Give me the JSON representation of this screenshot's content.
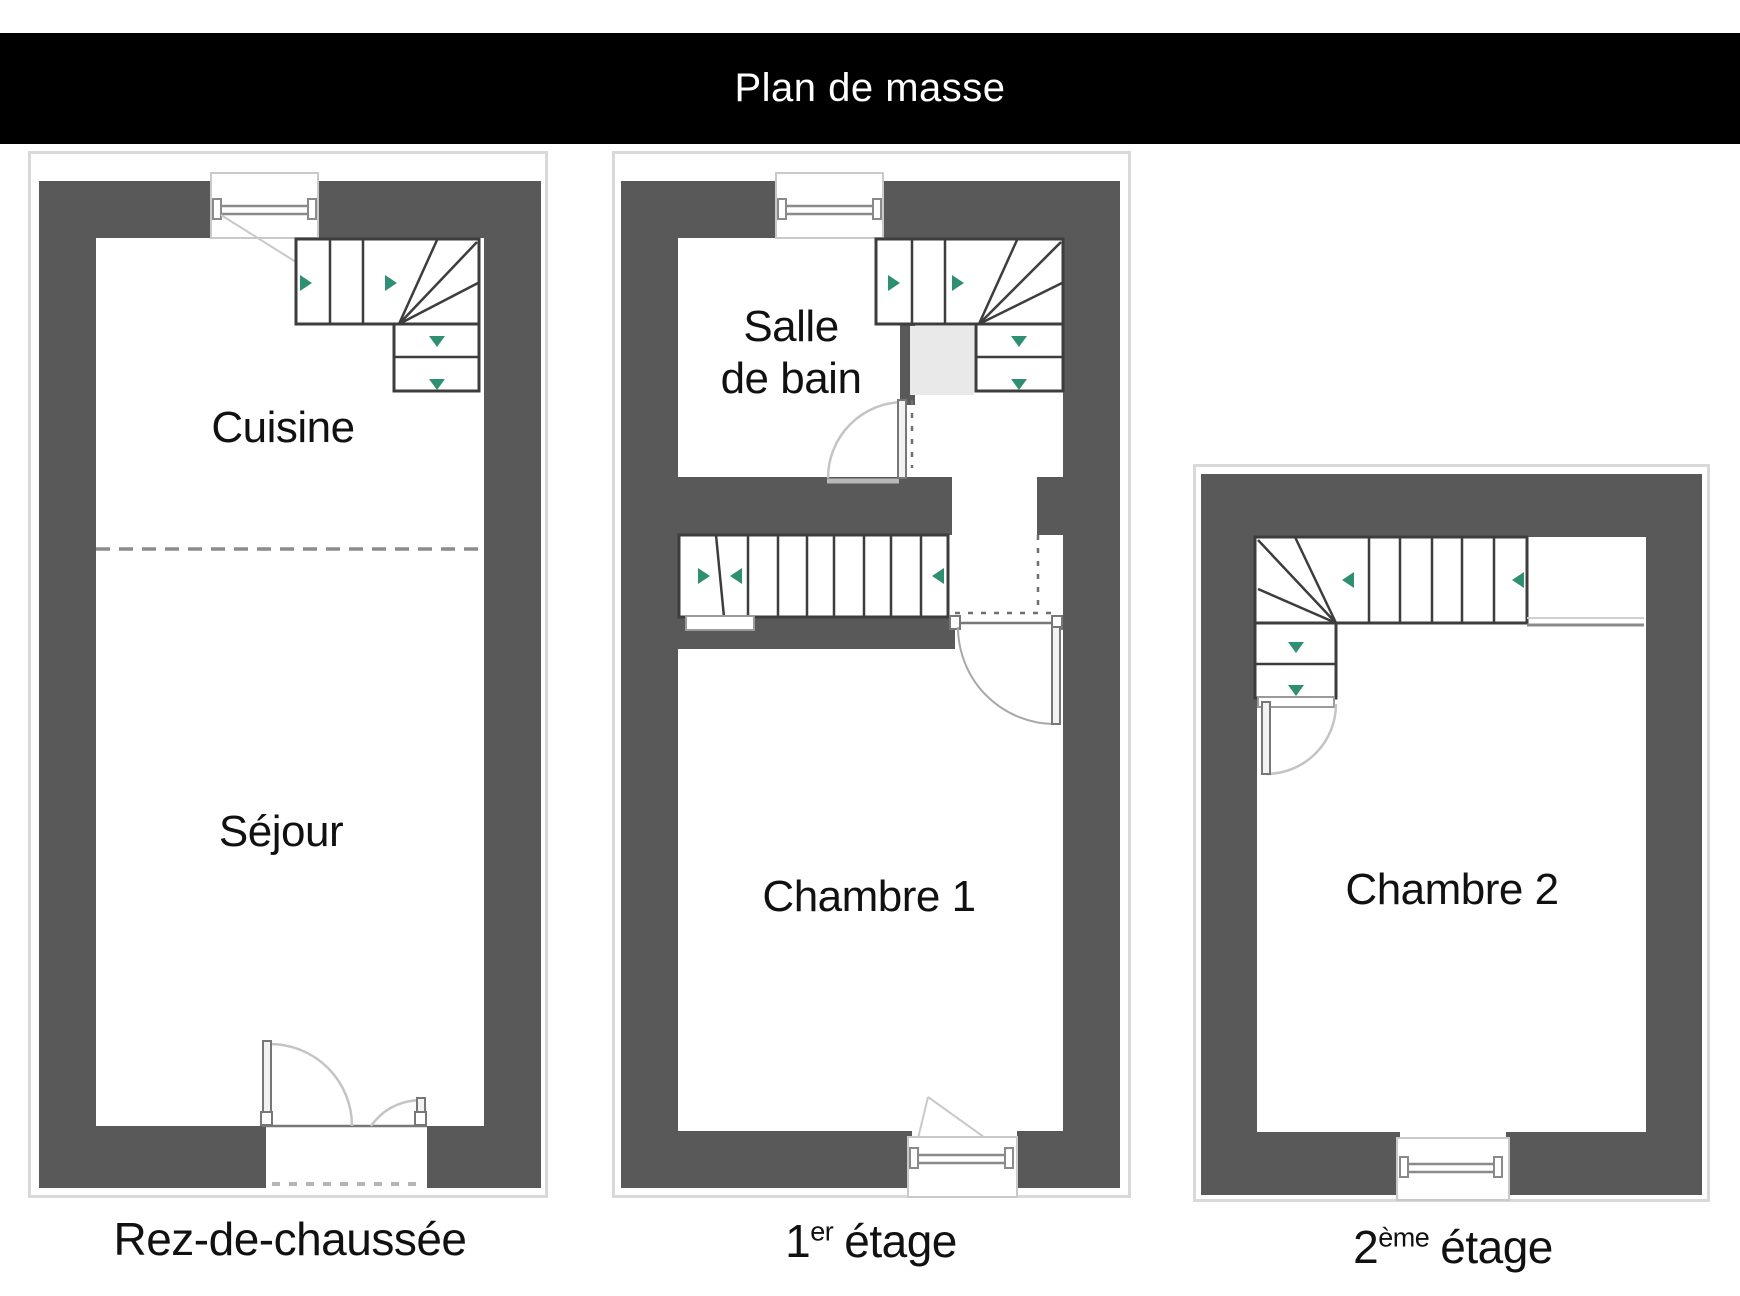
{
  "title": "Plan de masse",
  "colors": {
    "title_bg": "#000000",
    "title_text": "#ffffff",
    "wall": "#595959",
    "frame": "#d9d9d9",
    "stair_outline": "#3d3d3d",
    "arrow_green": "#2f8f72",
    "swing_arc": "#c4c4c4",
    "shade": "#e9e9e9",
    "label_text": "#111111"
  },
  "icons": {
    "stair_direction_arrow": "filled-triangle (green), points along stair travel",
    "window_symbol": "double parallel lines with end caps in wall opening",
    "door_swing": "quarter-circle arc with door leaf"
  },
  "floors": [
    {
      "id": "rdc",
      "caption": {
        "num": "Rez-de-chaussée",
        "sup": "",
        "rest": ""
      },
      "rooms": [
        {
          "label": "Cuisine"
        },
        {
          "label": "Séjour"
        }
      ]
    },
    {
      "id": "etage1",
      "caption": {
        "num": "1",
        "sup": "er",
        "rest": "étage"
      },
      "rooms": [
        {
          "label_line1": "Salle",
          "label_line2": "de bain"
        },
        {
          "label": "Chambre 1"
        }
      ]
    },
    {
      "id": "etage2",
      "caption": {
        "num": "2",
        "sup": "ème",
        "rest": "étage"
      },
      "rooms": [
        {
          "label": "Chambre 2"
        }
      ]
    }
  ]
}
